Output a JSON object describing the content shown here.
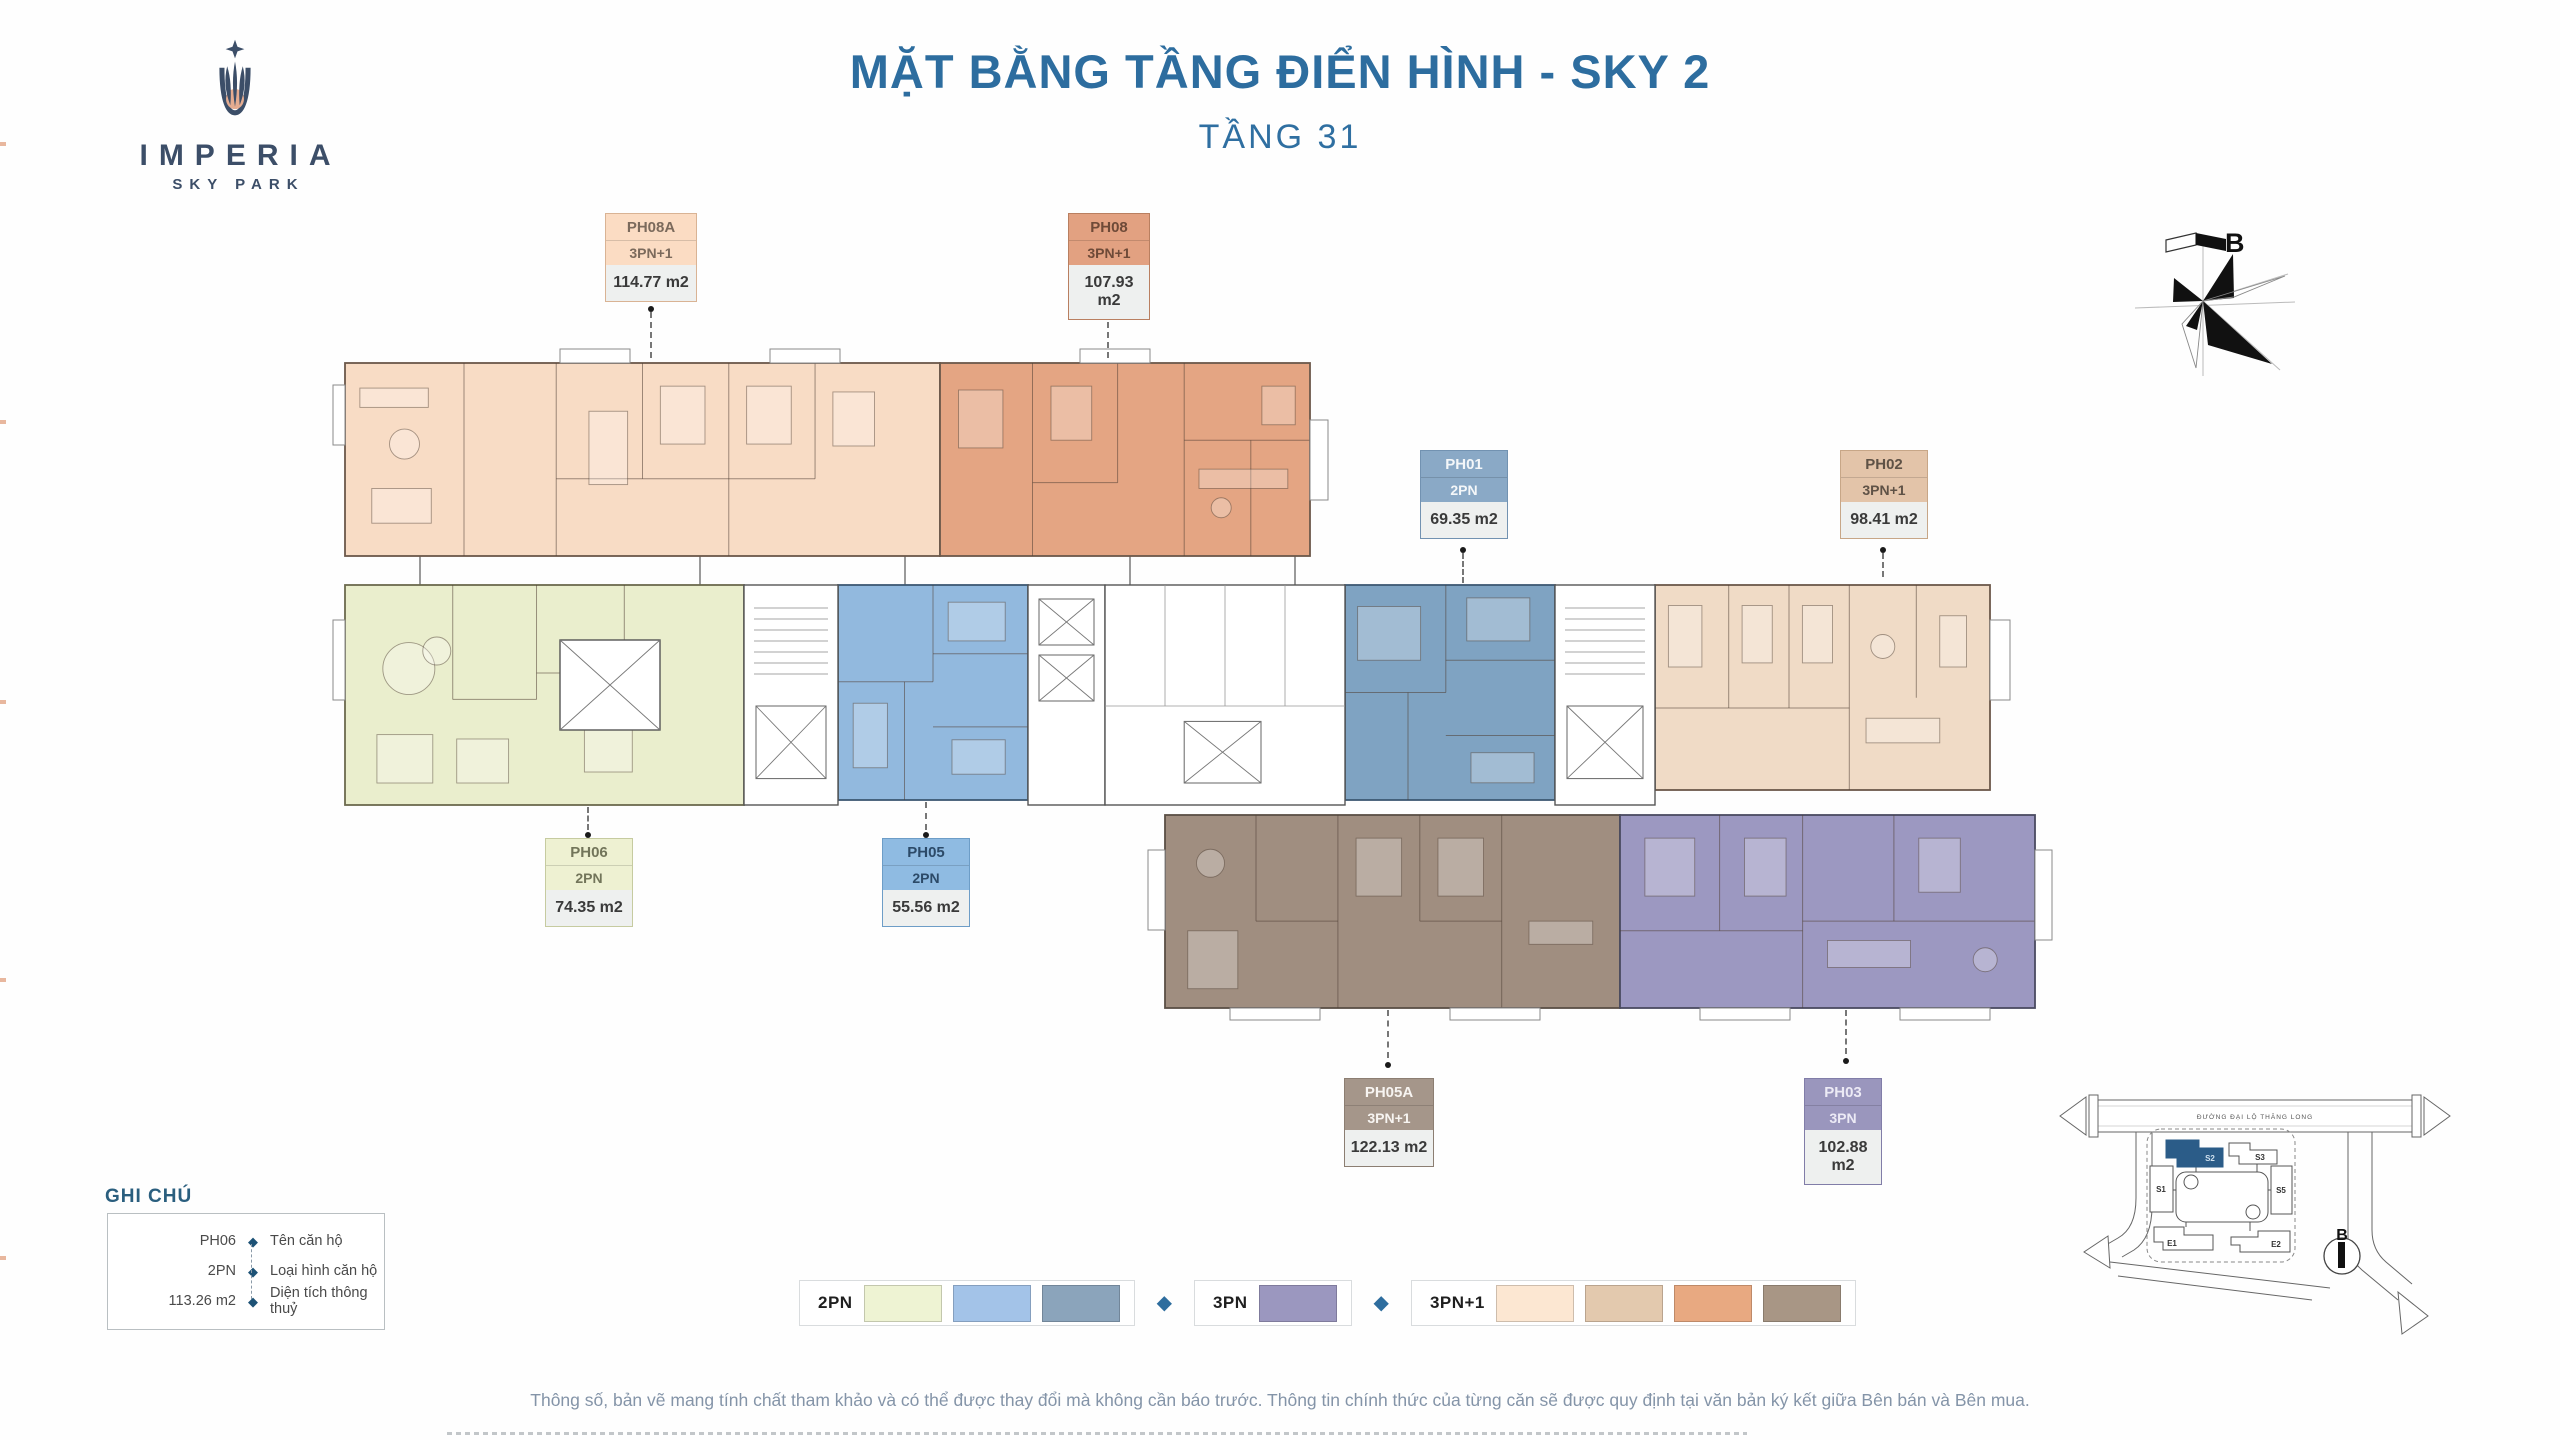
{
  "page": {
    "title": "MẶT BẰNG TẦNG ĐIỂN HÌNH - SKY 2",
    "subtitle": "TẦNG 31",
    "disclaimer": "Thông số, bản vẽ mang tính chất tham khảo và có thể được thay đổi mà không cần báo trước. Thông tin chính thức của từng căn sẽ được quy định tại văn bản ký kết giữa Bên bán và Bên mua.",
    "title_color": "#2d6d9f"
  },
  "logo": {
    "name": "IMPERIA",
    "tagline": "SKY PARK",
    "navy": "#3c4e68",
    "peach": "#e5ac90"
  },
  "compass": {
    "label": "B"
  },
  "units": [
    {
      "id": "PH08A",
      "type": "3PN+1",
      "area": "114.77 m2",
      "label_bg": "#fbdcc3",
      "label_text": "#7b6a5c",
      "label_border": "#d9b394",
      "plan_fill": "#f8dcc5"
    },
    {
      "id": "PH08",
      "type": "3PN+1",
      "area": "107.93 m2",
      "label_bg": "#e2a181",
      "label_text": "#6e4a38",
      "label_border": "#b97f60",
      "plan_fill": "#e4a583"
    },
    {
      "id": "PH01",
      "type": "2PN",
      "area": "69.35 m2",
      "label_bg": "#8aa9c6",
      "label_text": "#f4f7f9",
      "label_border": "#7292b1",
      "plan_fill": "#7fa3c2"
    },
    {
      "id": "PH02",
      "type": "3PN+1",
      "area": "98.41 m2",
      "label_bg": "#e3c4a9",
      "label_text": "#5f5246",
      "label_border": "#c7a687",
      "plan_fill": "#f0dbc6"
    },
    {
      "id": "PH06",
      "type": "2PN",
      "area": "74.35 m2",
      "label_bg": "#eef1d2",
      "label_text": "#72755a",
      "label_border": "#c6cba0",
      "plan_fill": "#eaeecd"
    },
    {
      "id": "PH05",
      "type": "2PN",
      "area": "55.56 m2",
      "label_bg": "#8fbbe2",
      "label_text": "#2c4a68",
      "label_border": "#6d9dc7",
      "plan_fill": "#92b9de"
    },
    {
      "id": "PH05A",
      "type": "3PN+1",
      "area": "122.13 m2",
      "label_bg": "#a5968a",
      "label_text": "#f7f4f1",
      "label_border": "#8c7e72",
      "plan_fill": "#a08e80"
    },
    {
      "id": "PH03",
      "type": "3PN",
      "area": "102.88 m2",
      "label_bg": "#9a96bd",
      "label_text": "#eceaf5",
      "label_border": "#817da8",
      "plan_fill": "#9c98c1"
    }
  ],
  "legend_key": {
    "title": "GHI CHÚ",
    "rows": [
      {
        "sample": "PH06",
        "desc": "Tên căn hộ"
      },
      {
        "sample": "2PN",
        "desc": "Loại hình căn hộ"
      },
      {
        "sample": "113.26 m2",
        "desc": "Diện tích thông thuỷ"
      }
    ],
    "bullet_color": "#1d5276"
  },
  "type_legend": {
    "groups": [
      {
        "label": "2PN",
        "swatches": [
          "#eef3d3",
          "#a3c3e8",
          "#8ba4bb"
        ]
      },
      {
        "label": "3PN",
        "swatches": [
          "#9b97bf"
        ]
      },
      {
        "label": "3PN+1",
        "swatches": [
          "#fce7d2",
          "#e3c9ae",
          "#e8a981",
          "#a89685"
        ]
      }
    ],
    "separator_color": "#2e6d9e"
  },
  "site_map": {
    "road_label": "ĐƯỜNG ĐẠI LỘ THĂNG LONG",
    "buildings": [
      {
        "label": "S1",
        "highlight": false
      },
      {
        "label": "S2",
        "highlight": true
      },
      {
        "label": "S3",
        "highlight": false
      },
      {
        "label": "S5",
        "highlight": false
      },
      {
        "label": "E1",
        "highlight": false
      },
      {
        "label": "E2",
        "highlight": false
      }
    ],
    "highlight_color": "#2b5c88",
    "compass_label": "B"
  }
}
